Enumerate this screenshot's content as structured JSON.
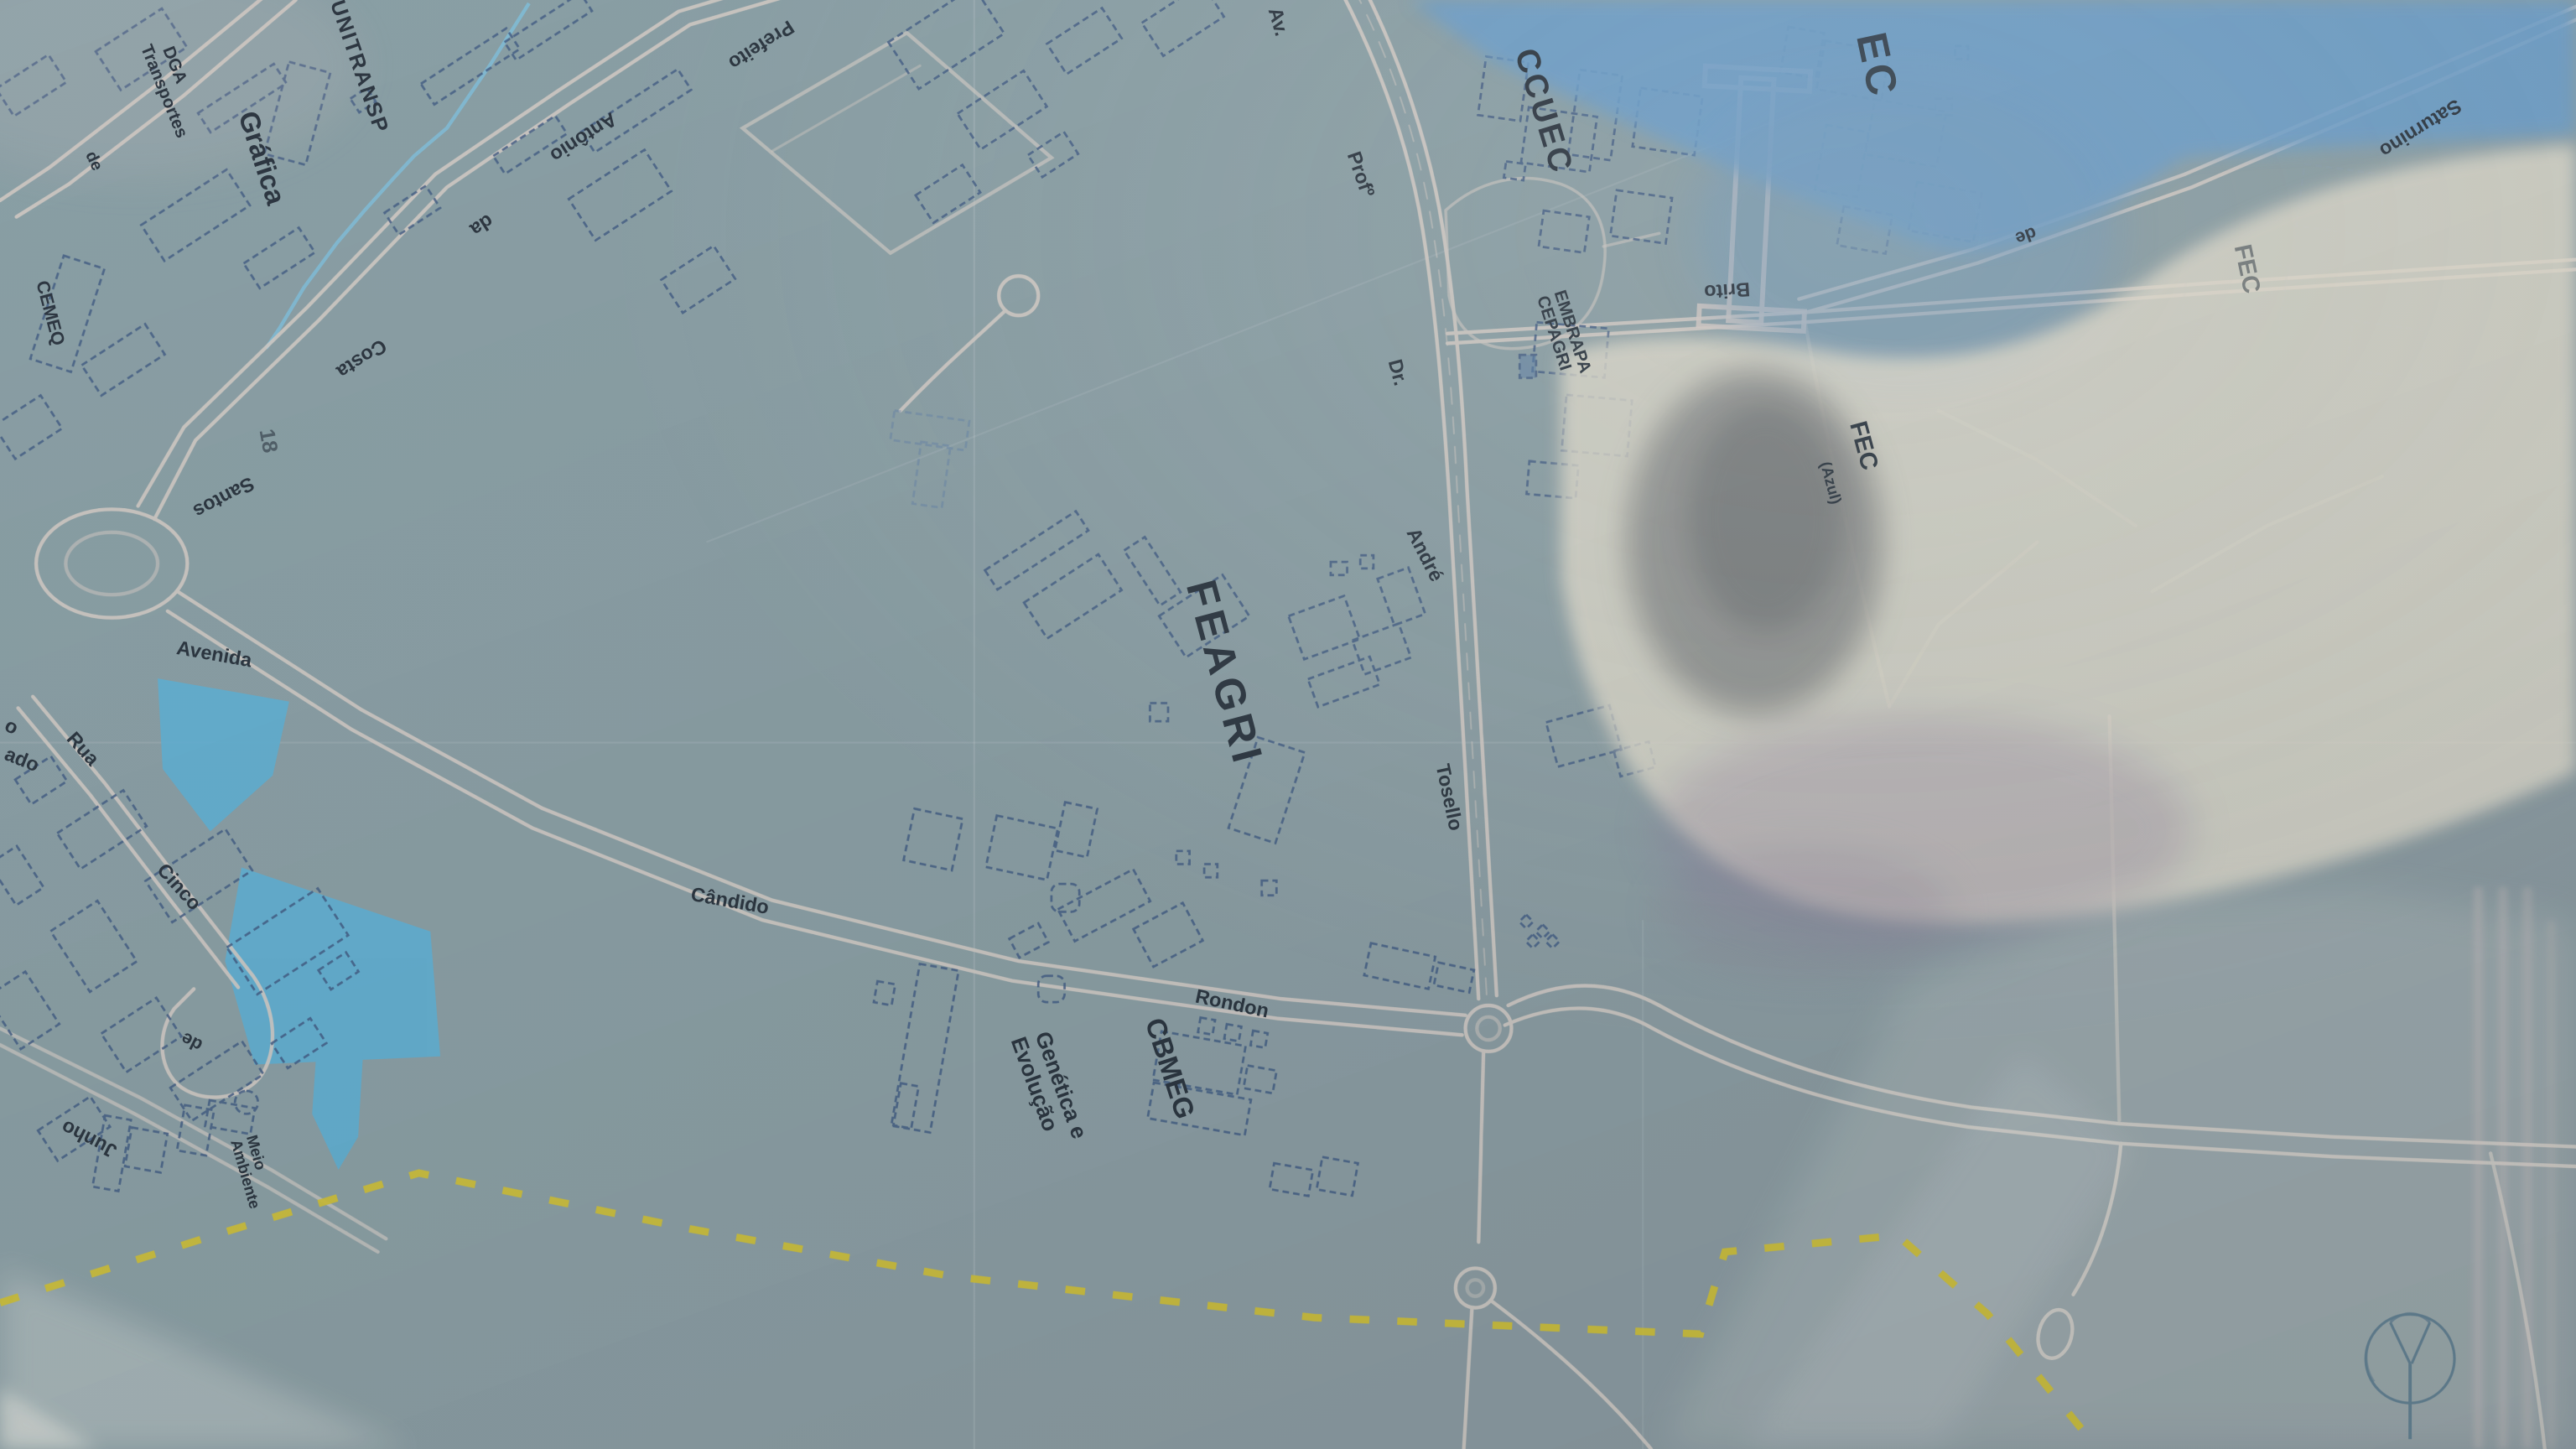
{
  "streets": {
    "av": "Av.",
    "prof": "Profº",
    "dr": "Dr.",
    "andre": "André",
    "tosello": "Tosello",
    "prefeito": "Prefeito",
    "antonio": "Antônio",
    "da": "da",
    "costa": "Costa",
    "santos": "Santos",
    "avenida": "Avenida",
    "candido": "Cândido",
    "rondon": "Rondon",
    "rua": "Rua",
    "cinco": "Cinco",
    "de_junho": "de",
    "junho": "Junho",
    "saturnino": "Saturnino",
    "de_brito": "de",
    "brito": "Brito",
    "fragment_o": "o",
    "fragment_ado": "ado"
  },
  "places": {
    "unitransp": "UNITRANSP",
    "dga": "DGA",
    "dga2": "Transportes",
    "grafica": "Gráfica",
    "de_grafica": "de",
    "cemeq": "CEMEQ",
    "ccuec": "CCUEC",
    "embrapa": "EMBRAPA",
    "cepagri": "CEPAGRI",
    "ec": "EC",
    "fec": "FEC",
    "fec_azul": "(Azul)",
    "fec_faint": "FEC",
    "feagri": "FEAGRI",
    "cbmeg": "CBMEG",
    "genetica1": "Genética e",
    "genetica2": "Evolução",
    "meio1": "Meio",
    "meio2": "Ambiente",
    "building_number": "18"
  },
  "legend": {
    "boundary_color": "#d6c428",
    "water_color": "#5ab4dc",
    "road_color": "#d8cfc8",
    "building_outline_color": "#3f5c88",
    "label_color": "#26303b",
    "fec_label_color": "#a39367",
    "sky_reflection_color": "#66a0d2",
    "glare_reflection_color": "#eae2cf"
  }
}
